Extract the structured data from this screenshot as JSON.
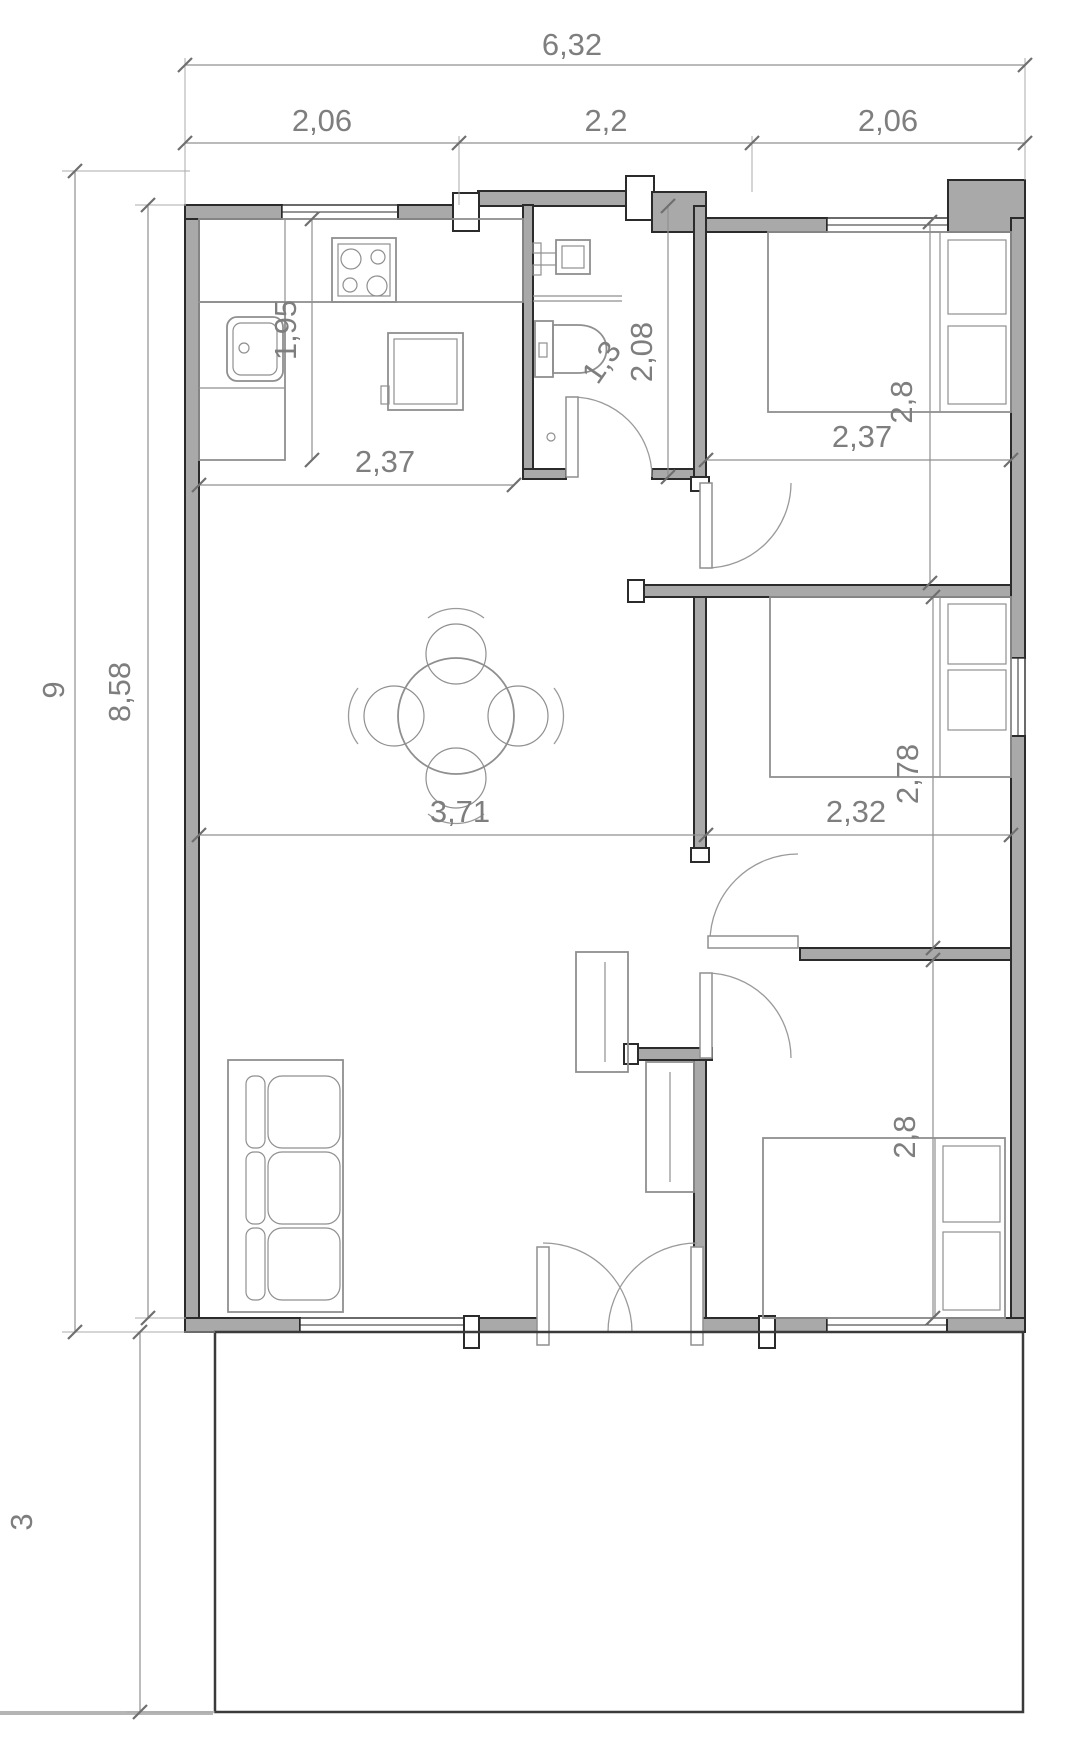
{
  "drawing": {
    "type": "floor-plan",
    "colors": {
      "wall_fill": "#a9a9a9",
      "wall_stroke": "#2b2b2b",
      "furniture_stroke": "#8f8f8f",
      "dimension_line": "#909090",
      "dimension_text": "#7e7e7e",
      "background": "#ffffff"
    },
    "dims": {
      "overall_width": "6,32",
      "top_segments": [
        "2,06",
        "2,2",
        "2,06"
      ],
      "overall_height": "9",
      "interior_height": "8,58",
      "terrace_depth": "3",
      "kitchen_depth": "1,95",
      "kitchen_width": "2,37",
      "bathroom_width": "1,3",
      "bathroom_depth": "2,08",
      "bedroom1_width": "2,37",
      "bedroom1_depth": "2,8",
      "living_width": "3,71",
      "bedroom2_width": "2,32",
      "bedroom2_depth": "2,78",
      "bedroom3_depth": "2,8"
    }
  }
}
